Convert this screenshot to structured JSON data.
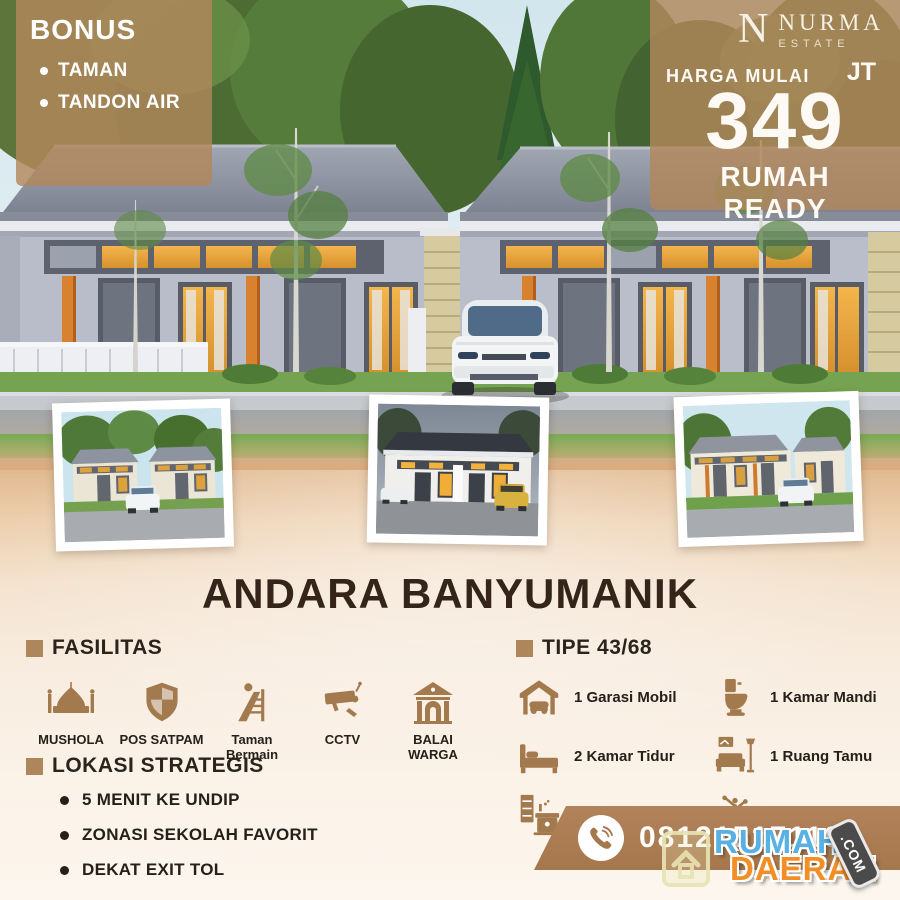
{
  "theme": {
    "accent-brown": "#a3794e",
    "overlay-tan": "rgba(178,135,92,0.82)",
    "ribbon-brown": "#a6764c",
    "title-brown": "#34241a",
    "text-dark": "#26201a",
    "wm-blue": "#58b0e3",
    "wm-orange": "#f28e26"
  },
  "bonus": {
    "title": "BONUS",
    "items": [
      "TAMAN",
      "TANDON AIR"
    ]
  },
  "brand": {
    "monogram": "N",
    "name": "NURMA",
    "subtitle": "ESTATE"
  },
  "price": {
    "label": "HARGA MULAI",
    "unit": "JT",
    "amount": "349",
    "status": "RUMAH READY"
  },
  "main_title": "ANDARA BANYUMANIK",
  "facilities": {
    "heading": "FASILITAS",
    "items": [
      {
        "icon": "mosque-icon",
        "label": "MUSHOLA"
      },
      {
        "icon": "shield-icon",
        "label": "POS SATPAM"
      },
      {
        "icon": "playground-icon",
        "label": "Taman Bermain"
      },
      {
        "icon": "cctv-icon",
        "label": "CCTV"
      },
      {
        "icon": "community-hall-icon",
        "label": "BALAI WARGA"
      }
    ]
  },
  "spec": {
    "heading": "TIPE 43/68",
    "items": [
      {
        "icon": "garage-icon",
        "label": "1 Garasi Mobil"
      },
      {
        "icon": "toilet-icon",
        "label": "1 Kamar Mandi"
      },
      {
        "icon": "bed-icon",
        "label": "2 Kamar Tidur"
      },
      {
        "icon": "sofa-icon",
        "label": "1 Ruang Tamu"
      },
      {
        "icon": "kitchen-icon",
        "label": "1 Dapur"
      },
      {
        "icon": "tree-icon",
        "label": "1 Taman"
      }
    ]
  },
  "location": {
    "heading": "LOKASI STRATEGIS",
    "items": [
      "5 MENIT KE UNDIP",
      "ZONASI SEKOLAH FAVORIT",
      "DEKAT EXIT TOL"
    ]
  },
  "contact": {
    "phone": "081215171197",
    "icon": "phone-icon"
  },
  "watermark": {
    "icon": "house-icon",
    "line1": "RUMAH",
    "line2": "DAERAH",
    "suffix": ".COM"
  }
}
